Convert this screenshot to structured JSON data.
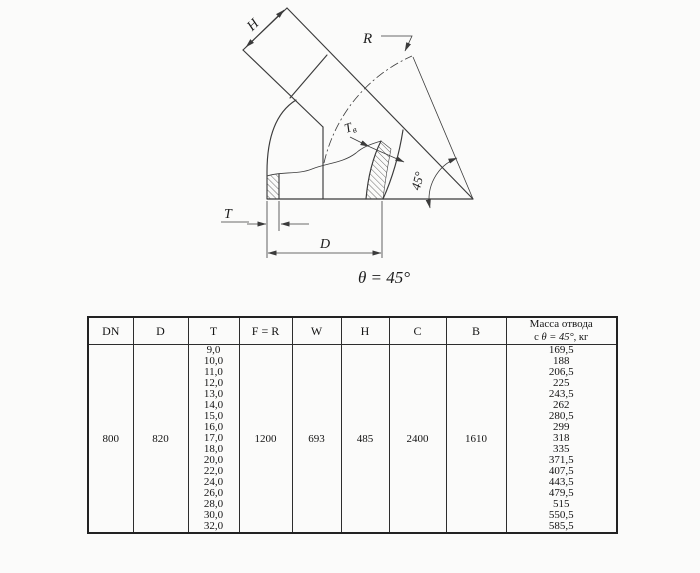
{
  "drawing": {
    "labels": {
      "h": "H",
      "r": "R",
      "t_inner_main": "T",
      "t_inner_sub": "в",
      "t": "T",
      "d": "D",
      "angle_45": "45°",
      "theta": "θ = 45°"
    }
  },
  "table": {
    "headers": {
      "dn": "DN",
      "d": "D",
      "t": "T",
      "f_r": "F = R",
      "w": "W",
      "h": "H",
      "c": "C",
      "b": "B"
    },
    "mass_header": {
      "line1": "Масса отвода",
      "prefix": "с",
      "angle": "θ = 45°",
      "suffix": ", кг"
    },
    "row": {
      "dn": "800",
      "d": "820",
      "f_r": "1200",
      "w": "693",
      "h": "485",
      "c": "2400",
      "b": "1610",
      "t_values": [
        "9,0",
        "10,0",
        "11,0",
        "12,0",
        "13,0",
        "14,0",
        "15,0",
        "16,0",
        "17,0",
        "18,0",
        "20,0",
        "22,0",
        "24,0",
        "26,0",
        "28,0",
        "30,0",
        "32,0"
      ],
      "mass_values": [
        "169,5",
        "188",
        "206,5",
        "225",
        "243,5",
        "262",
        "280,5",
        "299",
        "318",
        "335",
        "371,5",
        "407,5",
        "443,5",
        "479,5",
        "515",
        "550,5",
        "585,5"
      ]
    }
  }
}
